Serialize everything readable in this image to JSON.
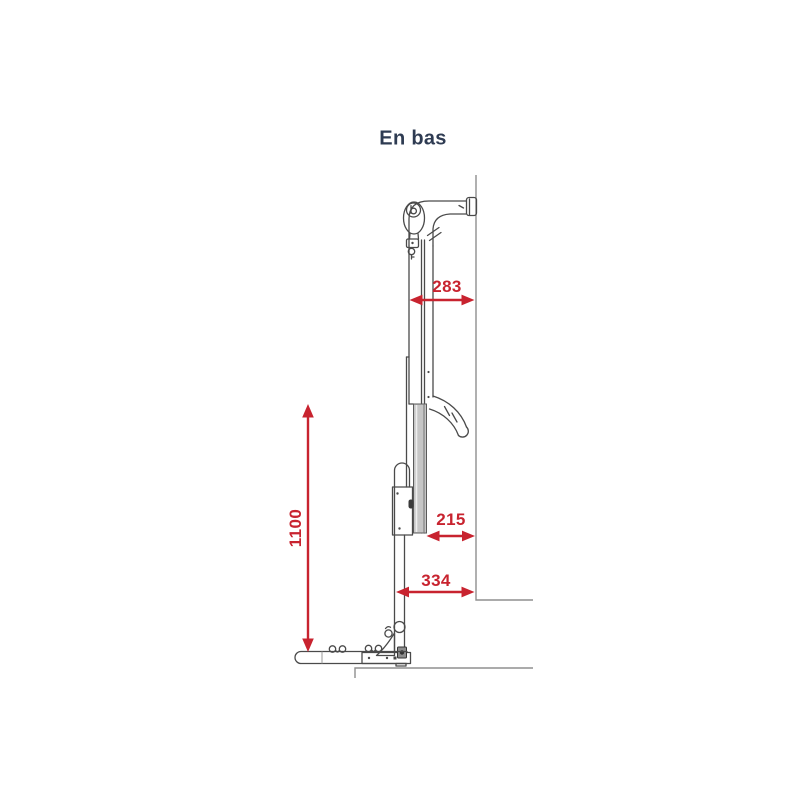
{
  "title": "En bas",
  "colors": {
    "dimension": "#c8232f",
    "title_text": "#2e3b52",
    "line_art": "#4a4a4a",
    "guide_lines": "#8f8f8f"
  },
  "diagram": {
    "type": "technical-dimension-drawing",
    "view_label": "En bas",
    "dimensions": {
      "top_width": {
        "value": "283",
        "orientation": "horizontal"
      },
      "mid_width": {
        "value": "215",
        "orientation": "horizontal"
      },
      "bottom_width": {
        "value": "334",
        "orientation": "horizontal"
      },
      "height": {
        "value": "1100",
        "orientation": "vertical"
      }
    }
  }
}
